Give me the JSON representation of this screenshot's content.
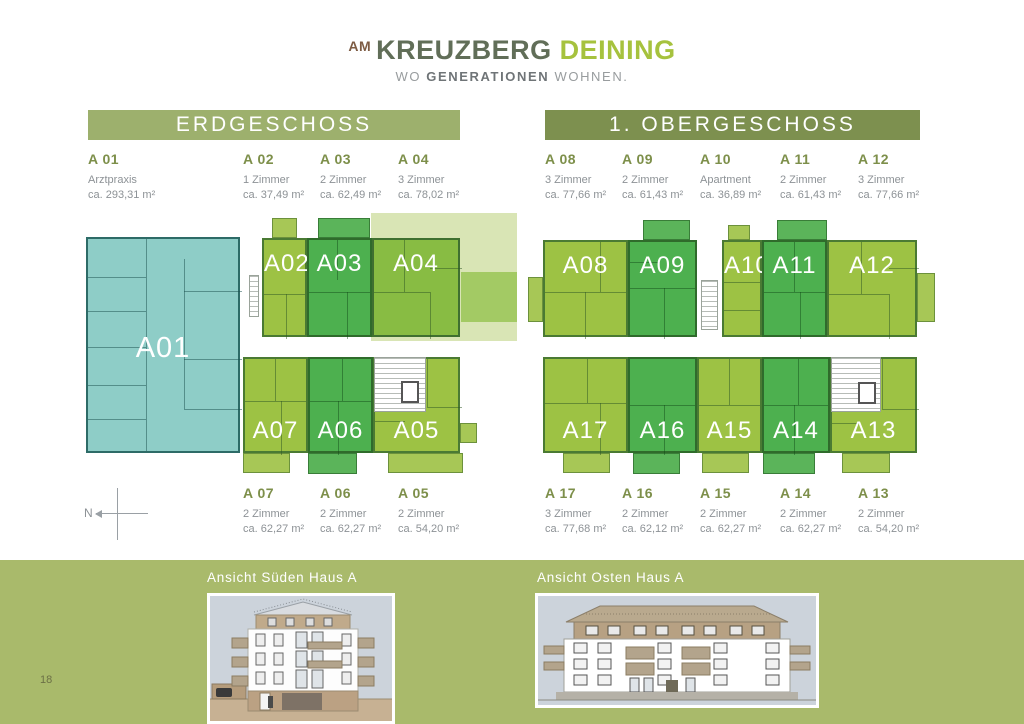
{
  "brand": {
    "prefix": "AM",
    "name_dark": "KREUZBERG",
    "name_green": "DEINING",
    "tagline_lead": "WO",
    "tagline_bold": "GENERATIONEN",
    "tagline_tail": "WOHNEN."
  },
  "floors": {
    "eg": {
      "title": "ERDGESCHOSS",
      "top": [
        {
          "id": "A 01",
          "line1": "Arztpraxis",
          "line2": "ca. 293,31 m²"
        },
        {
          "id": "A 02",
          "line1": "1 Zimmer",
          "line2": "ca. 37,49 m²"
        },
        {
          "id": "A 03",
          "line1": "2 Zimmer",
          "line2": "ca. 62,49 m²"
        },
        {
          "id": "A 04",
          "line1": "3 Zimmer",
          "line2": "ca. 78,02 m²"
        }
      ],
      "bottom": [
        {
          "id": "A 07",
          "line1": "2 Zimmer",
          "line2": "ca. 62,27 m²"
        },
        {
          "id": "A 06",
          "line1": "2 Zimmer",
          "line2": "ca. 62,27 m²"
        },
        {
          "id": "A 05",
          "line1": "2 Zimmer",
          "line2": "ca. 54,20 m²"
        }
      ],
      "plan": {
        "a01": "A01",
        "a02": "A02",
        "a03": "A03",
        "a04": "A04",
        "a05": "A05",
        "a06": "A06",
        "a07": "A07"
      }
    },
    "og": {
      "title": "1. OBERGESCHOSS",
      "top": [
        {
          "id": "A 08",
          "line1": "3 Zimmer",
          "line2": "ca. 77,66 m²"
        },
        {
          "id": "A 09",
          "line1": "2 Zimmer",
          "line2": "ca. 61,43 m²"
        },
        {
          "id": "A 10",
          "line1": "Apartment",
          "line2": "ca. 36,89 m²"
        },
        {
          "id": "A 11",
          "line1": "2 Zimmer",
          "line2": "ca. 61,43 m²"
        },
        {
          "id": "A 12",
          "line1": "3 Zimmer",
          "line2": "ca. 77,66 m²"
        }
      ],
      "bottom": [
        {
          "id": "A 17",
          "line1": "3 Zimmer",
          "line2": "ca. 77,68 m²"
        },
        {
          "id": "A 16",
          "line1": "2 Zimmer",
          "line2": "ca. 62,12 m²"
        },
        {
          "id": "A 15",
          "line1": "2 Zimmer",
          "line2": "ca. 62,27 m²"
        },
        {
          "id": "A 14",
          "line1": "2 Zimmer",
          "line2": "ca. 62,27 m²"
        },
        {
          "id": "A 13",
          "line1": "2 Zimmer",
          "line2": "ca. 54,20 m²"
        }
      ],
      "plan": {
        "a08": "A08",
        "a09": "A09",
        "a10": "A10",
        "a11": "A11",
        "a12": "A12",
        "a13": "A13",
        "a14": "A14",
        "a15": "A15",
        "a16": "A16",
        "a17": "A17"
      }
    }
  },
  "compass": {
    "label": "N"
  },
  "footer": {
    "page_number": "18",
    "caption_south": "Ansicht Süden Haus A",
    "caption_east": "Ansicht Osten Haus A"
  },
  "colors": {
    "teal_unit": "#8ecdc7",
    "light_green_unit": "#9dc244",
    "mid_green_unit": "#4db04f",
    "bar_erdgeschoss": "#9db06d",
    "bar_obergeschoss": "#7d904f",
    "footer_band": "#a9ba6b",
    "brand_green": "#a6c23e",
    "brand_brown": "#7d5b43",
    "listing_id_green": "#7d8f4a",
    "text_gray": "#8d9296"
  }
}
